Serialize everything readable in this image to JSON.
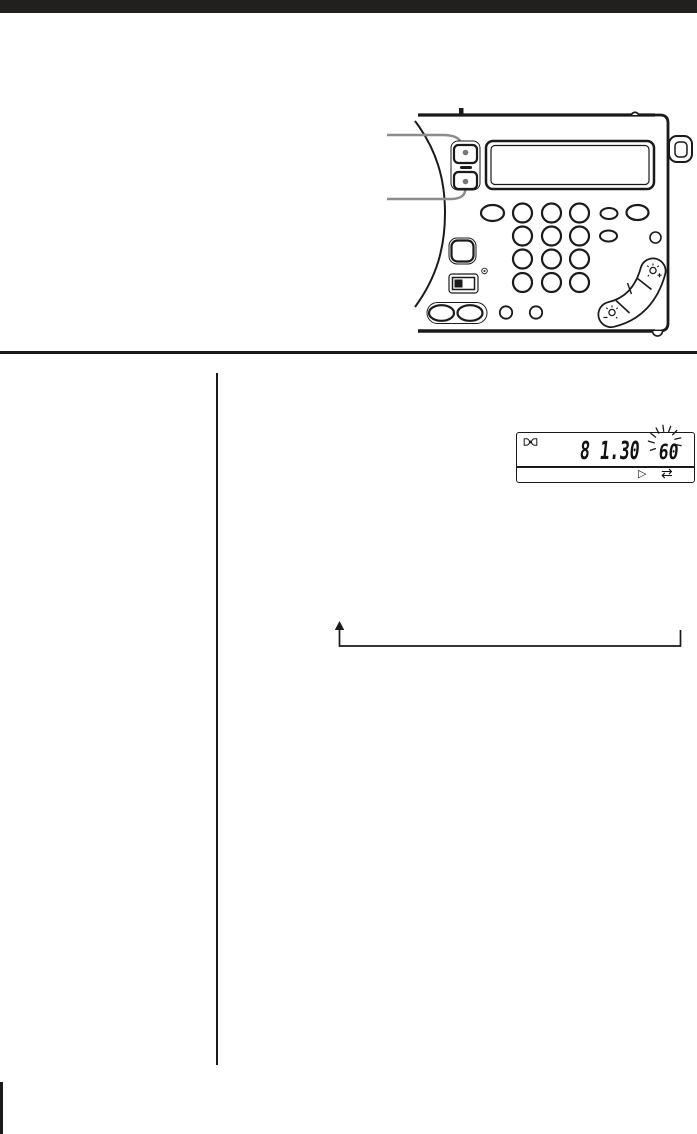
{
  "colors": {
    "ink": "#1a1a1a",
    "top_bar": "#221f1f",
    "callout_gray": "#8c8c8c"
  },
  "manual_page": {
    "lcd_detail": {
      "frequency_display": "8 1.30",
      "sleep_timer_minutes": "60",
      "sleep_indicator_icon": "standby-indicator",
      "play_icon": "▷",
      "sync_arrows_icon": "⇄"
    },
    "device_icons": {
      "tune_plus_icon": "sun-plus",
      "tune_minus_icon": "sun-minus",
      "highlighted_buttons": "sleep-up-down-buttons"
    }
  }
}
